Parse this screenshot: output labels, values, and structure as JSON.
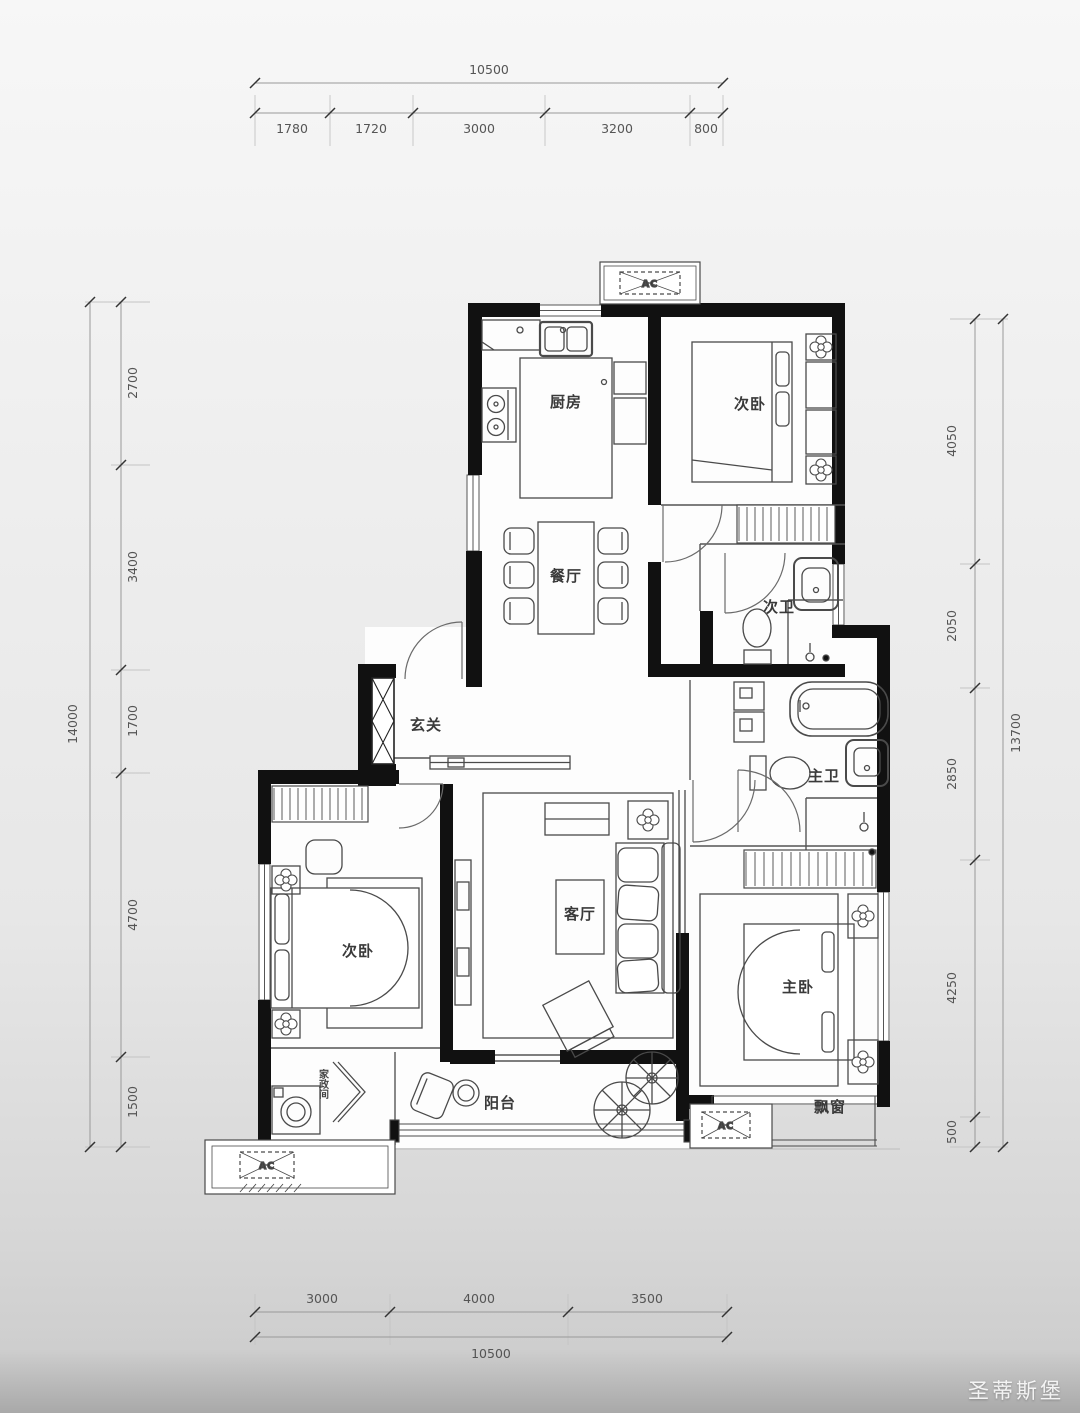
{
  "dimensions": {
    "top": {
      "total": "10500",
      "segments": [
        "1780",
        "1720",
        "3000",
        "3200",
        "800"
      ]
    },
    "bottom": {
      "total": "10500",
      "segments": [
        "3000",
        "4000",
        "3500"
      ]
    },
    "left": {
      "total": "14000",
      "segments": [
        "2700",
        "3400",
        "1700",
        "4700",
        "1500"
      ]
    },
    "right": {
      "total": "13700",
      "segments": [
        "4050",
        "2050",
        "2850",
        "4250",
        "500"
      ]
    }
  },
  "room_labels": {
    "kitchen": "厨房",
    "bedroom_top": "次卧",
    "dining": "餐厅",
    "bath_secondary": "次卫",
    "foyer": "玄关",
    "bath_master": "主卫",
    "living": "客厅",
    "bedroom_left": "次卧",
    "bedroom_master": "主卧",
    "balcony": "阳台",
    "bay_window": "飘窗",
    "laundry": "家政间"
  },
  "ac_label": "AC",
  "watermark": "圣蒂斯堡",
  "colors": {
    "wall": "#111111",
    "furniture_line": "#4a4a4a",
    "dim_line": "#999999",
    "dim_tick": "#333333"
  }
}
